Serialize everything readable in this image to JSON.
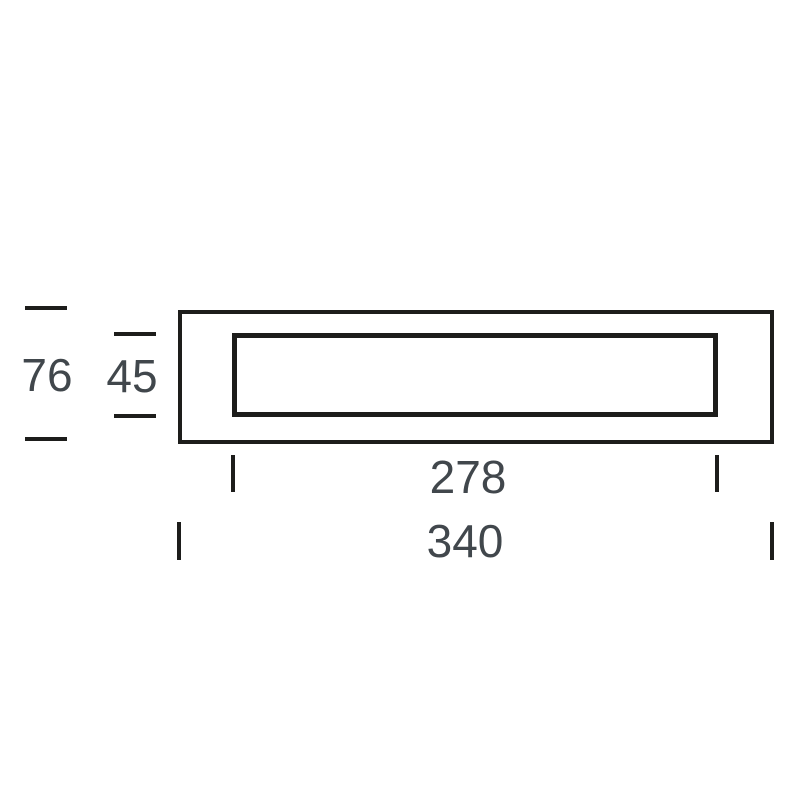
{
  "colors": {
    "background": "#ffffff",
    "line": "#1d1d1b",
    "text": "#41474c"
  },
  "drawing": {
    "type": "technical-dimension-diagram",
    "labels": {
      "outer_height": "76",
      "inner_height": "45",
      "inner_width": "278",
      "outer_width": "340"
    }
  }
}
